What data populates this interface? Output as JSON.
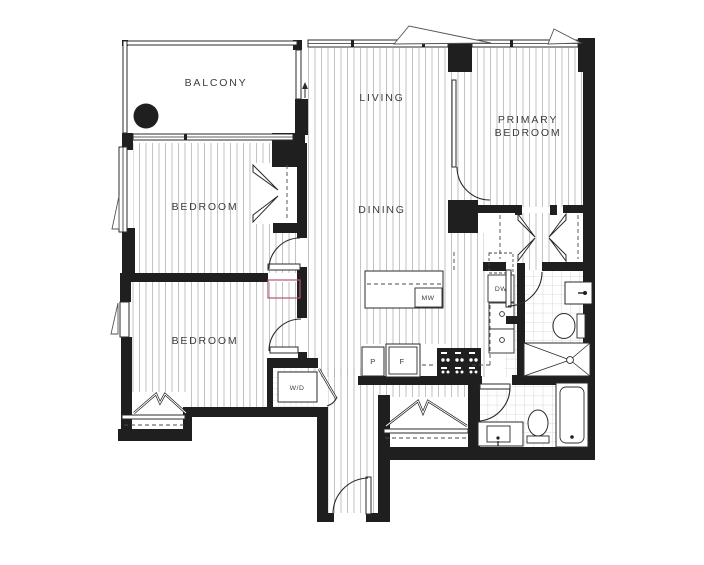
{
  "plan": {
    "rooms": {
      "balcony": "BALCONY",
      "living": "LIVING",
      "dining": "DINING",
      "primary_line1": "PRIMARY",
      "primary_line2": "BEDROOM",
      "bedroom1": "BEDROOM",
      "bedroom2": "BEDROOM"
    },
    "fixtures": {
      "washer_dryer": "W/D",
      "microwave": "MW",
      "dishwasher": "DW",
      "pantry": "P",
      "fridge": "F"
    },
    "colors": {
      "wall": "#1f1f1f",
      "hatch_line": "#b3b3b3",
      "tile_line": "#cfcfcf",
      "label_text": "#3d3d3d",
      "highlight": "#b05578",
      "background": "#ffffff"
    }
  }
}
